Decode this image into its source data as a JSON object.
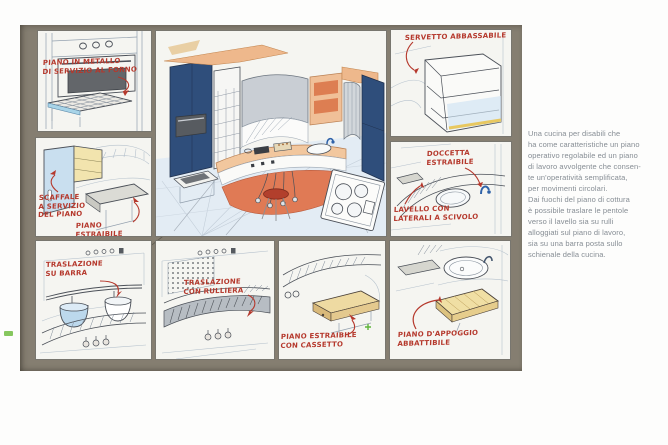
{
  "colors": {
    "board_background": "#857e71",
    "panel_background": "#f5f5f1",
    "annotation_red": "#b5382c",
    "caption_gray": "#868d94",
    "cabinet_navy": "#2f4e7b",
    "countertop_peach": "#eeb88c",
    "base_salmon": "#e07a55",
    "floor_blue": "#e3ecf4",
    "wood_yellow": "#eedaa2",
    "wash_lightblue": "#c9dfef",
    "page_marker_green": "#79c14c"
  },
  "annotations": {
    "oven_shelf": "PIANO IN METALLO\nDI SERVIZIO AL FORNO",
    "servetto": "SERVETTO ABBASSABILE",
    "scaffale": "SCAFFALE\nA SERVIZIO\nDEL PIANO",
    "piano_estraibile": "PIANO ESTRAIBILE",
    "doccetta": "DOCCETTA\nESTRAIBILE",
    "lavello": "LAVELLO CON\nLATERALI A SCIVOLO",
    "traslazione_barra": "TRASLAZIONE\nSU BARRA",
    "traslazione_rulliera": "TRASLAZIONE\nCON RULLIERA",
    "piano_cassetto": "PIANO ESTRAIBILE\nCON CASSETTO",
    "piano_appoggio": "PIANO D'APPOGGIO\nABBATTIBILE"
  },
  "body_text": {
    "paragraph": "Una cucina per disabili che\nha come caratteristiche un piano\noperativo regolabile ed un piano\ndi lavoro avvolgente che consen-\nte un'operatività semplificata,\nper movimenti circolari.\nDai fuochi del piano di cottura\nè possibile traslare le pentole\nverso il lavello sia su rulli\nalloggiati sul piano di lavoro,\nsia su una barra posta sullo\nschienale della cucina."
  }
}
